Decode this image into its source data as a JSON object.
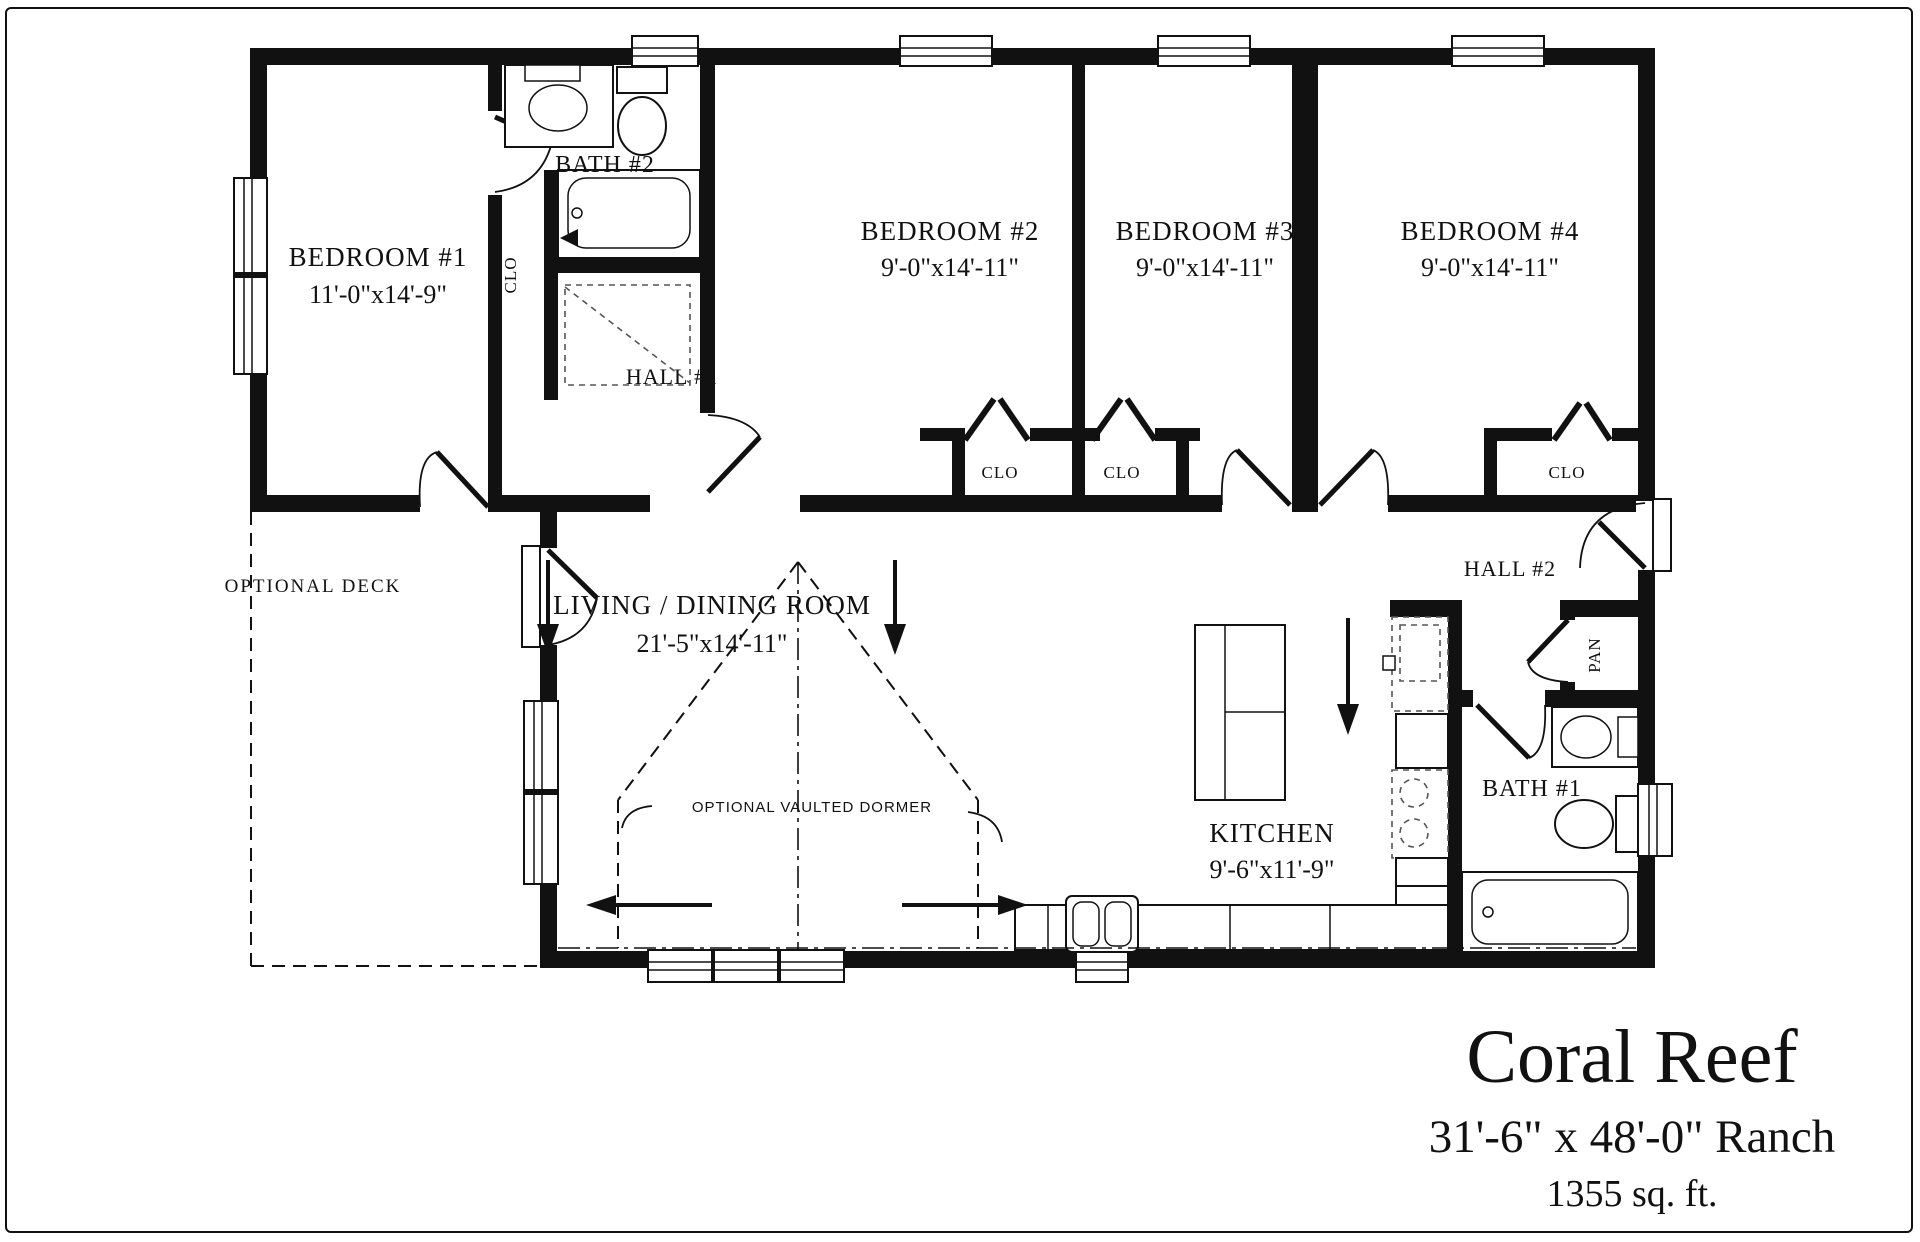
{
  "title_block": {
    "plan_name": "Coral Reef",
    "plan_size": "31'-6\" x 48'-0\" Ranch",
    "plan_area": "1355 sq. ft."
  },
  "rooms": {
    "bedroom1": {
      "label": "BEDROOM #1",
      "dims": "11'-0\"x14'-9\""
    },
    "bedroom2": {
      "label": "BEDROOM #2",
      "dims": "9'-0\"x14'-11\""
    },
    "bedroom3": {
      "label": "BEDROOM #3",
      "dims": "9'-0\"x14'-11\""
    },
    "bedroom4": {
      "label": "BEDROOM #4",
      "dims": "9'-0\"x14'-11\""
    },
    "living_dining": {
      "label": "LIVING / DINING ROOM",
      "dims": "21'-5\"x14'-11\""
    },
    "kitchen": {
      "label": "KITCHEN",
      "dims": "9'-6\"x11'-9\""
    },
    "bath1": {
      "label": "BATH #1"
    },
    "bath2": {
      "label": "BATH #2"
    },
    "hall1": {
      "label": "HALL #1"
    },
    "hall2": {
      "label": "HALL #2"
    },
    "deck": {
      "label": "OPTIONAL DECK"
    }
  },
  "closets": {
    "bath2_closet": "CLO",
    "bedroom2_closet": "CLO",
    "bedroom3_closet": "CLO",
    "bedroom4_closet": "CLO",
    "pantry": "PAN"
  },
  "annotations": {
    "dormer_note": "OPTIONAL VAULTED DORMER"
  },
  "colors": {
    "wall": "#111111",
    "background": "#ffffff"
  }
}
